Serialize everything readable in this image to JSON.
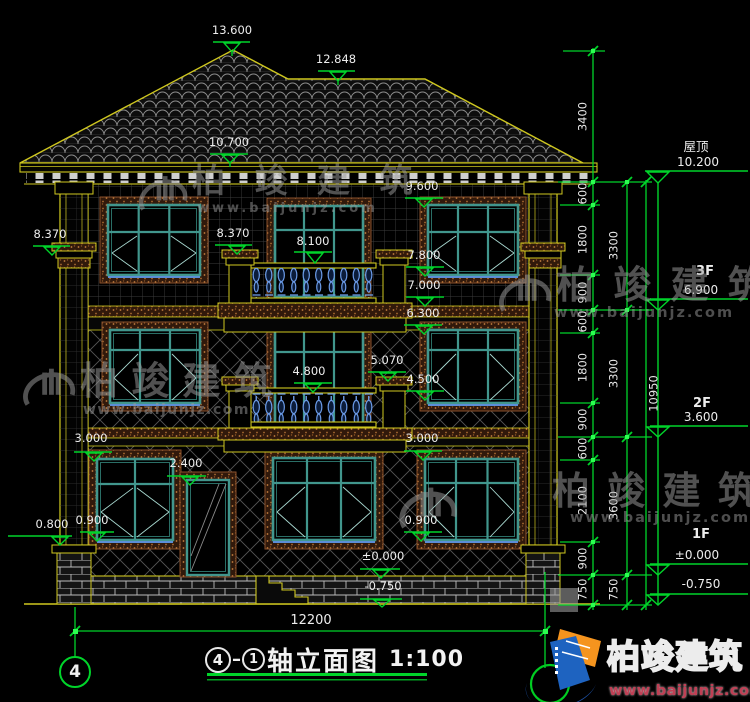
{
  "markers": {
    "building": [
      {
        "label": "13.600"
      },
      {
        "label": "12.848"
      },
      {
        "label": "10.700"
      },
      {
        "label": "9.600"
      },
      {
        "label": "8.370"
      },
      {
        "label": "8.370"
      },
      {
        "label": "8.100"
      },
      {
        "label": "7.800"
      },
      {
        "label": "7.000"
      },
      {
        "label": "6.300"
      },
      {
        "label": "5.070"
      },
      {
        "label": "4.800"
      },
      {
        "label": "4.500"
      },
      {
        "label": "3.000"
      },
      {
        "label": "3.000"
      },
      {
        "label": "2.400"
      },
      {
        "label": "0.900"
      },
      {
        "label": "0.800"
      },
      {
        "label": "0.900"
      },
      {
        "label": "±0.000"
      },
      {
        "label": "-0.750"
      }
    ],
    "floors": [
      {
        "name": "屋顶",
        "elev": "10.200"
      },
      {
        "name": "3F",
        "elev": "6.900"
      },
      {
        "name": "2F",
        "elev": "3.600"
      },
      {
        "name": "1F",
        "elev": "±0.000"
      },
      {
        "name": "",
        "elev": "-0.750"
      }
    ]
  },
  "dims": {
    "chain_inner": [
      "3400",
      "600",
      "1800",
      "900",
      "600",
      "1800",
      "900",
      "600",
      "2100",
      "900",
      "750"
    ],
    "chain_floor": [
      "3300",
      "3300",
      "3600",
      "750"
    ],
    "total_height": "10950",
    "total_width": "12200"
  },
  "titleblock": {
    "axis_start": "4",
    "axis_end": "1",
    "title": "轴立面图",
    "scale": "1:100",
    "axis_bubble_left": "4"
  },
  "watermark": {
    "brand": "柏 竣 建 筑",
    "url": "www.baijunjz.com"
  },
  "footer_logo": {
    "brand": "柏竣建筑",
    "url": "www.baijunjz.com"
  },
  "colors": {
    "line_green": "#00d42a",
    "cad_yellow": "#cfc71f",
    "window_teal": "#41968d",
    "baluster_blue": "#6b9be8"
  }
}
